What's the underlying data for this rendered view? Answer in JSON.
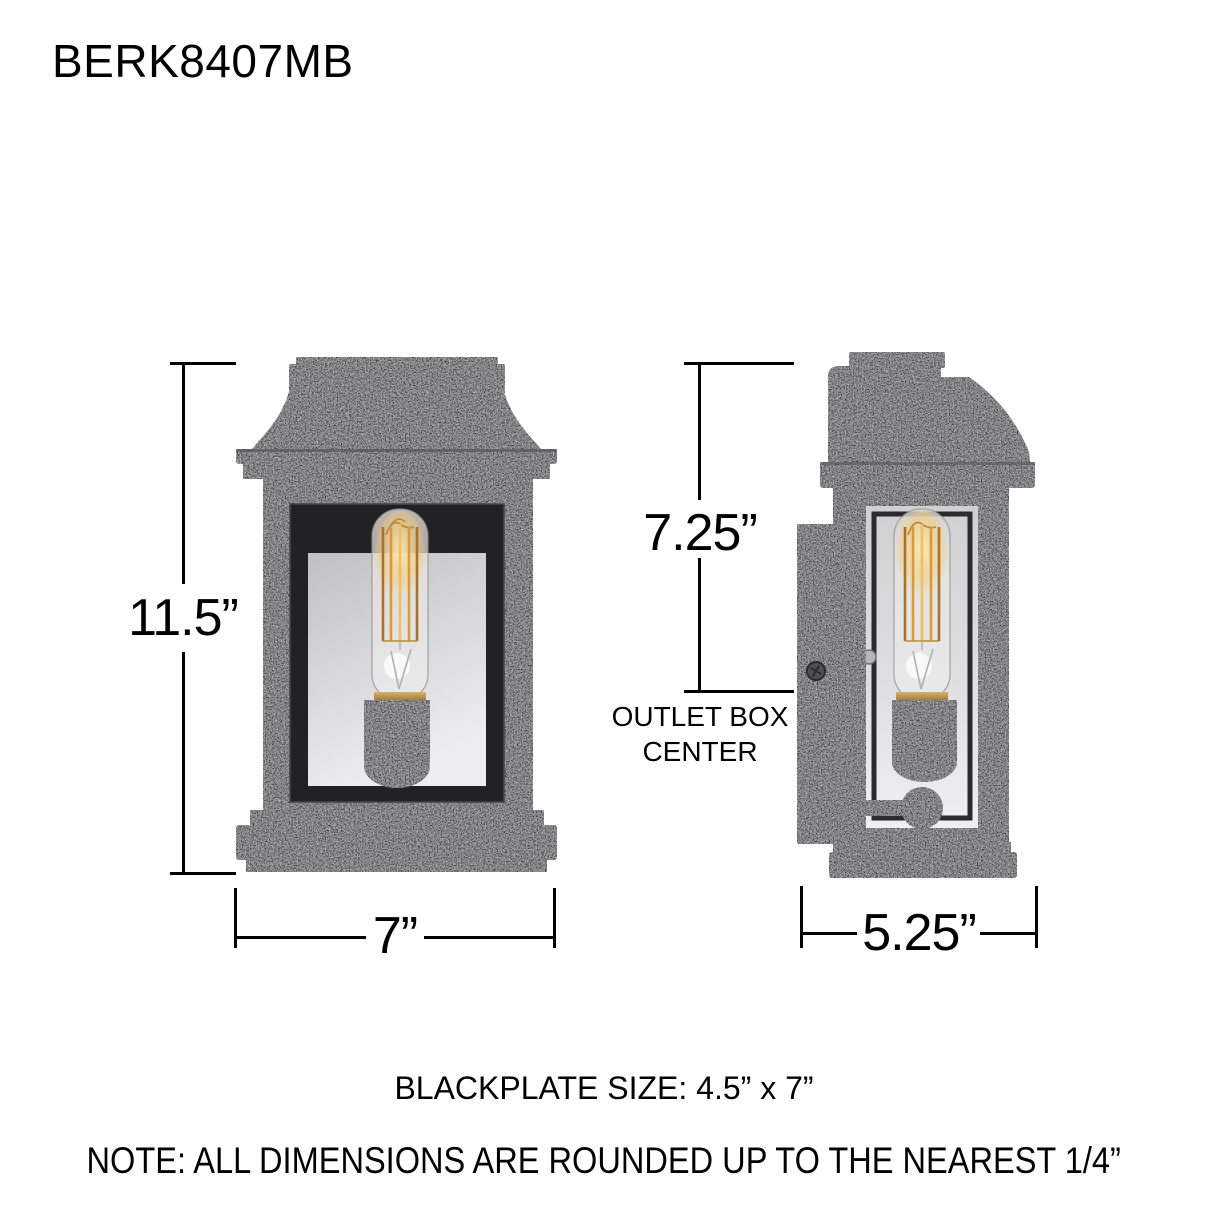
{
  "title": "BERK8407MB",
  "dims": {
    "height": "11.5”",
    "width": "7”",
    "outlet_height": "7.25”",
    "depth": "5.25”",
    "outlet_box_line1": "OUTLET BOX",
    "outlet_box_line2": "CENTER"
  },
  "footer": {
    "backplate": "BLACKPLATE SIZE: 4.5” x 7”",
    "note": "NOTE: ALL DIMENSIONS ARE ROUNDED UP TO THE NEAREST 1/4”"
  },
  "colors": {
    "dimension_line": "#000000",
    "fixture_finish": "#333335",
    "fixture_shadow": "#222224",
    "backplate_silver": "#d6d6d8",
    "filament_amber": "#d89a3f"
  }
}
